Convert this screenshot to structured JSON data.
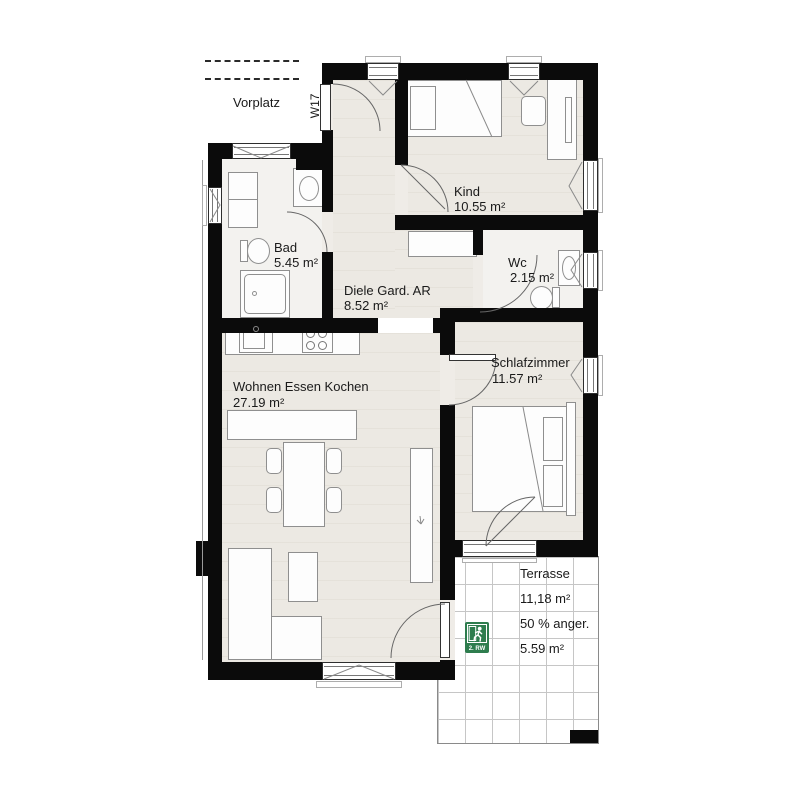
{
  "unit": {
    "code": "W17"
  },
  "rooms": {
    "vorplatz": {
      "name": "Vorplatz"
    },
    "kind": {
      "name": "Kind",
      "area": "10.55 m²"
    },
    "bad": {
      "name": "Bad",
      "area": "5.45 m²"
    },
    "diele": {
      "name": "Diele Gard. AR",
      "area": "8.52 m²"
    },
    "wc": {
      "name": "Wc",
      "area": "2.15 m²"
    },
    "schlafzimmer": {
      "name": "Schlafzimmer",
      "area": "11.57 m²"
    },
    "wohnen": {
      "name": "Wohnen Essen Kochen",
      "area": "27.19 m²"
    }
  },
  "terrace": {
    "name": "Terrasse",
    "gross_area": "11,18 m²",
    "note": "50 % anger.",
    "counted_area": "5.59 m²"
  },
  "escape_sign": {
    "label": "2. RW"
  },
  "colors": {
    "wall": "#0b0b0b",
    "floor": "#ece9e3",
    "wet_floor": "#f3f2ef",
    "terrace_grid": "#c6c6c6",
    "sign_green": "#2e7d4e"
  }
}
